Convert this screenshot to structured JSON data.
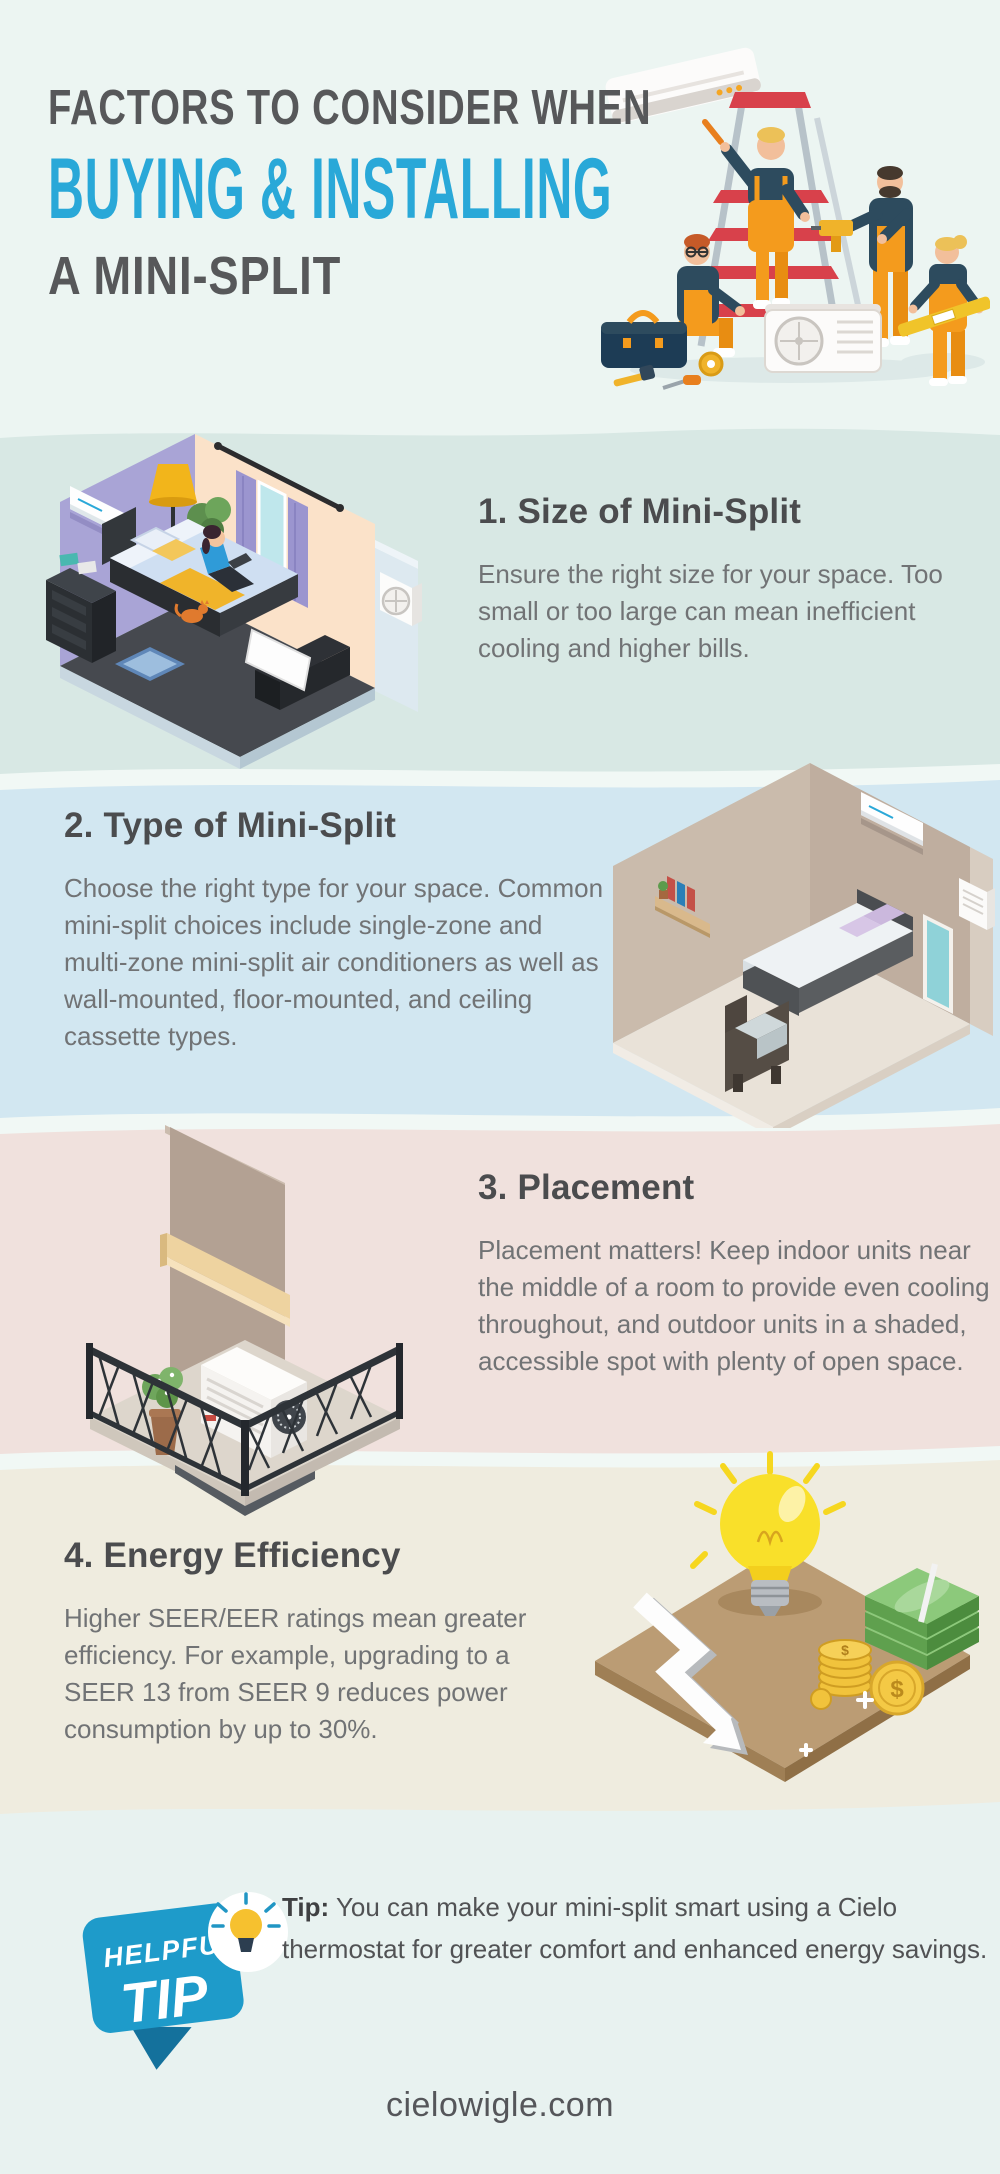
{
  "header": {
    "kicker": "FACTORS TO CONSIDER WHEN",
    "title": "BUYING & INSTALLING",
    "subtitle": "A MINI-SPLIT",
    "illustration": "technicians-installing-mini-split-on-ladder"
  },
  "sections": [
    {
      "heading": "1. Size of Mini-Split",
      "body": "Ensure the right size for your space. Too small or too large can mean inefficient cooling and higher bills.",
      "illustration": "isometric-bedroom-with-indoor-and-outdoor-unit",
      "bg": "#d8e8e4",
      "layout": "image-left"
    },
    {
      "heading": "2. Type of Mini-Split",
      "body": "Choose the right type for your space. Common mini-split choices include single-zone and multi-zone mini-split air conditioners as well as wall-mounted, floor-mounted, and ceiling cassette types.",
      "illustration": "isometric-bedroom-wall-mounted-unit",
      "bg": "#d2e7f1",
      "layout": "image-right"
    },
    {
      "heading": "3. Placement",
      "body": "Placement matters! Keep indoor units near the middle of a room to provide even cooling throughout, and outdoor units in a shaded, accessible spot with plenty of open space.",
      "illustration": "isometric-balcony-outdoor-unit",
      "bg": "#f0e1dd",
      "layout": "image-left"
    },
    {
      "heading": "4. Energy Efficiency",
      "body": "Higher SEER/EER ratings mean greater efficiency. For example, upgrading to a SEER 13 from SEER 9 reduces power consumption by up to 30%.",
      "illustration": "lightbulb-money-coins-savings",
      "bg": "#efecdf",
      "layout": "image-right"
    }
  ],
  "tip": {
    "badge_word1": "HELPFUL",
    "badge_word2": "TIP",
    "badge_icon": "lightbulb-icon",
    "label": "Tip:",
    "text": "You can make your mini-split smart using a Cielo thermostat for greater comfort and enhanced energy savings."
  },
  "footer": {
    "website": "cielowigle.com"
  },
  "colors": {
    "accent_blue": "#29a8d8",
    "heading_gray": "#4b4c4e",
    "body_gray": "#717375",
    "header_bg": "#ecf5f2",
    "section1_bg": "#d8e8e4",
    "section2_bg": "#d2e7f1",
    "section3_bg": "#f0e1dd",
    "section4_bg": "#efecdf",
    "footer_bg": "#e8f2f0",
    "tip_badge_blue": "#1e9bca"
  }
}
